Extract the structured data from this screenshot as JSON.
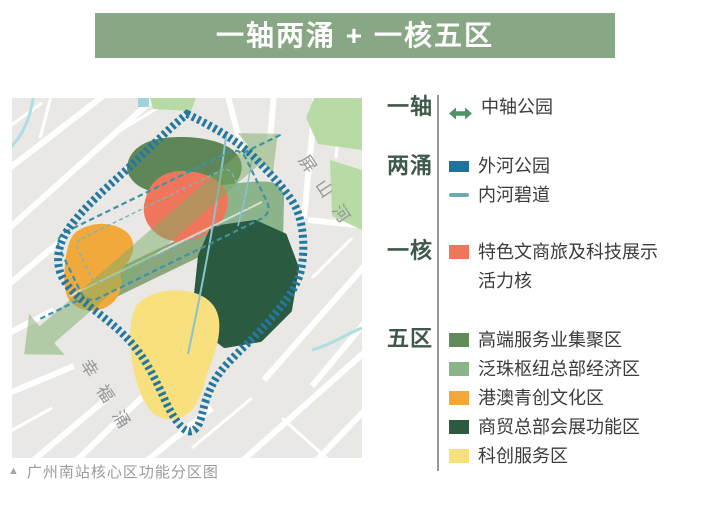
{
  "banner": {
    "title": "一轴两涌 + 一核五区",
    "bg_color": "#88a885",
    "text_color": "#ffffff"
  },
  "map": {
    "river_label_1": "屏山河",
    "river_label_2": "幸福涌",
    "caption_marker": "▲",
    "caption": "广州南站核心区功能分区图",
    "colors": {
      "background": "#e9e8e5",
      "outer_ring": "#2478a0",
      "inner_greenway": "#3b93a8",
      "axis_arrow": "#7cab66",
      "park": "#b8dba6"
    }
  },
  "legend": {
    "groups": [
      {
        "label": "一轴",
        "items": [
          {
            "name": "中轴公园",
            "swatch": "double-arrow",
            "color": "#4f9464"
          }
        ]
      },
      {
        "label": "两涌",
        "items": [
          {
            "name": "外河公园",
            "swatch": "thick-bar",
            "color": "#20719b"
          },
          {
            "name": "内河碧道",
            "swatch": "thin-line",
            "color": "#68aab6"
          }
        ]
      },
      {
        "label": "一核",
        "items": [
          {
            "name": "特色文商旅及科技展示活力核",
            "swatch": "rect",
            "color": "#f0765b"
          }
        ]
      },
      {
        "label": "五区",
        "items": [
          {
            "name": "高端服务业集聚区",
            "swatch": "rect",
            "color": "#648a5c"
          },
          {
            "name": "泛珠枢纽总部经济区",
            "swatch": "rect",
            "color": "#8cb48b"
          },
          {
            "name": "港澳青创文化区",
            "swatch": "rect",
            "color": "#f3a73b"
          },
          {
            "name": "商贸总部会展功能区",
            "swatch": "rect",
            "color": "#2b5a41"
          },
          {
            "name": "科创服务区",
            "swatch": "rect",
            "color": "#f6e17c"
          }
        ]
      }
    ]
  }
}
